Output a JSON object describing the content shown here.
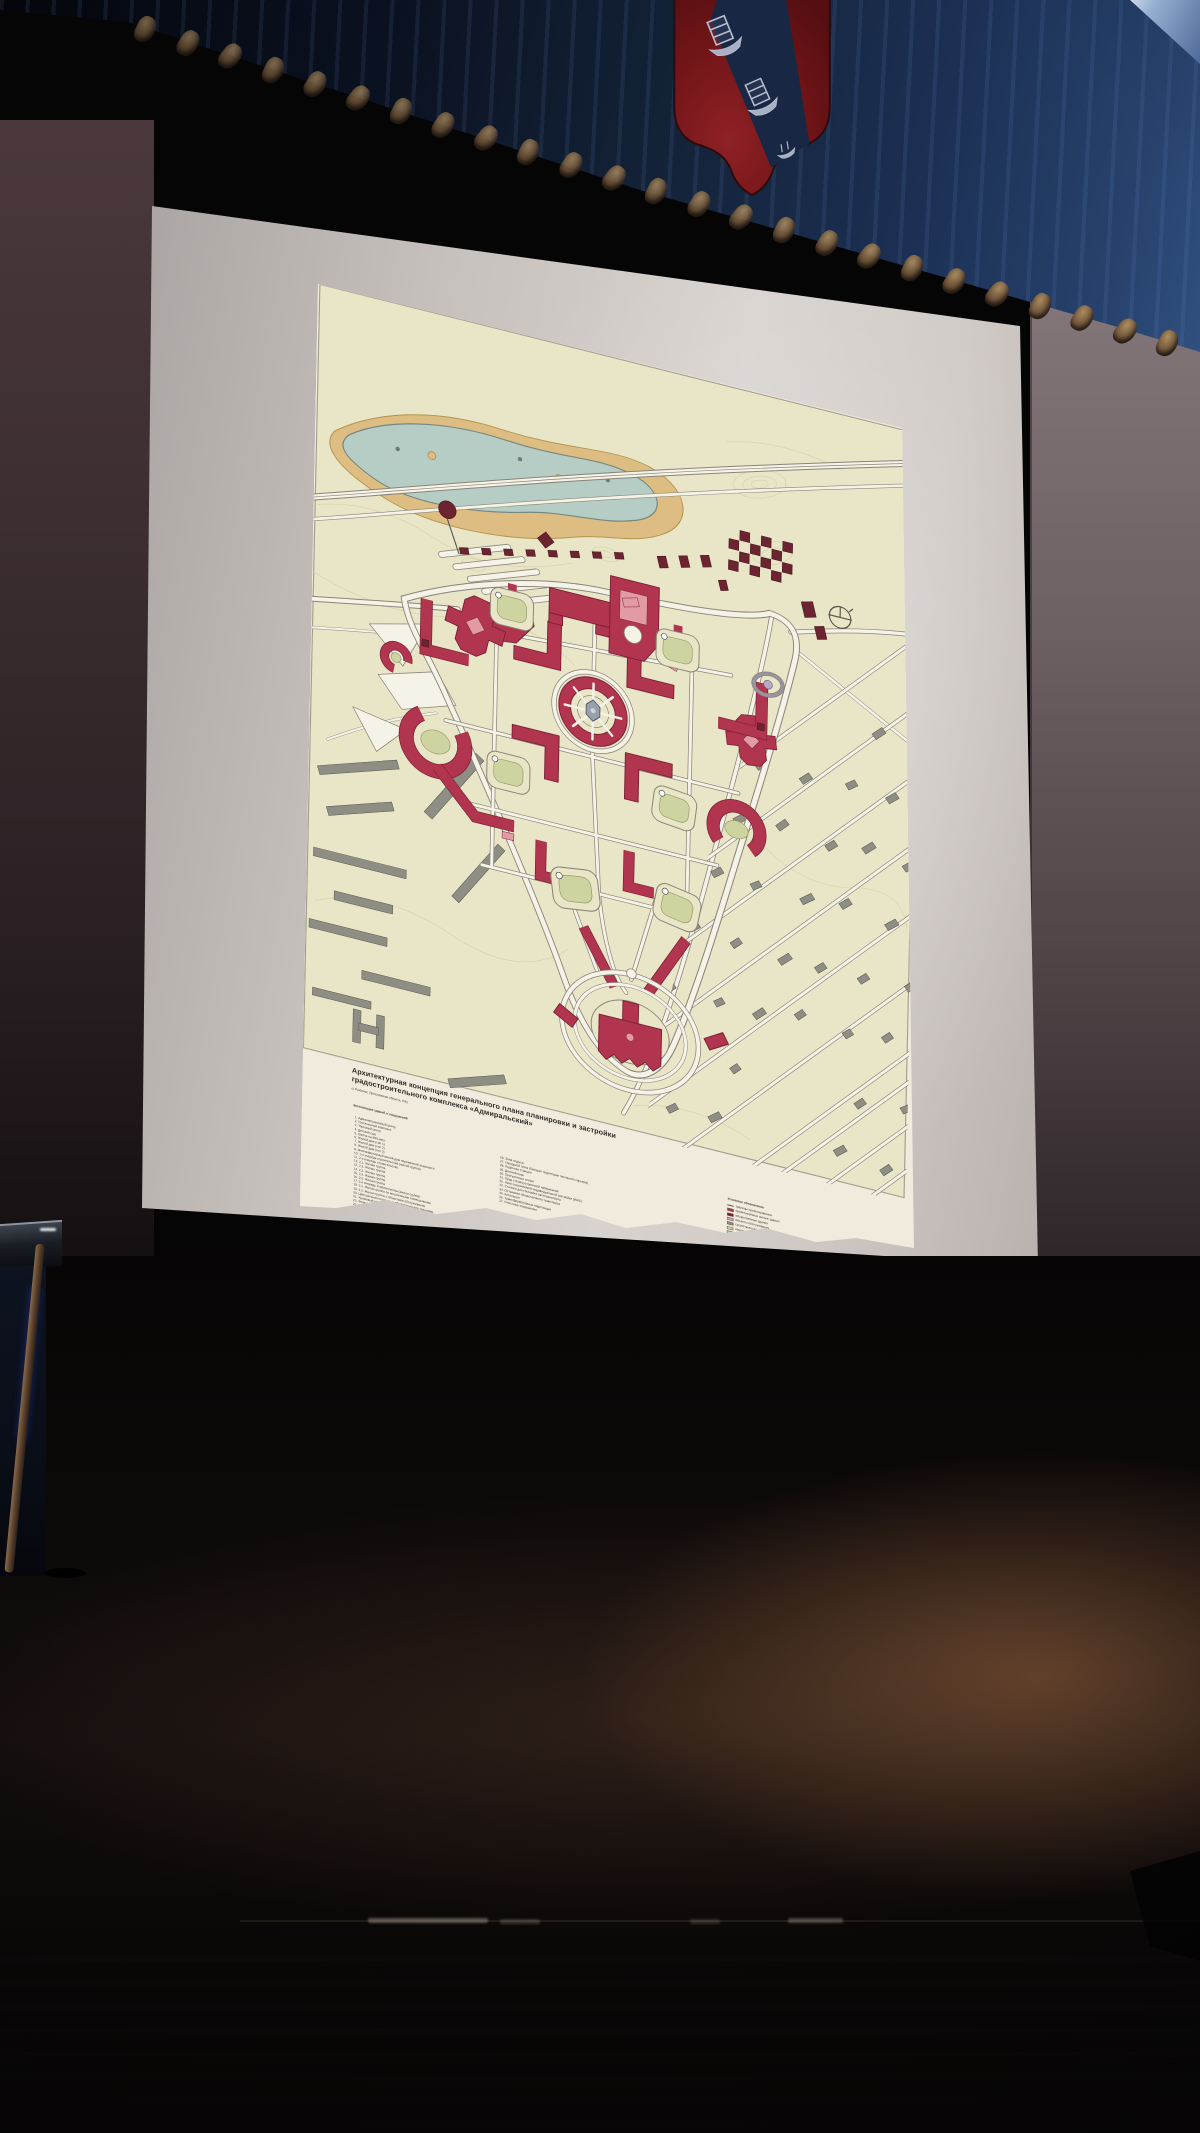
{
  "poster": {
    "title_line1": "Архитектурная концепция генерального плана планировки и застройки",
    "title_line2": "градостроительного комплекса «Адмиральский»",
    "subtitle": "(г. Рыбинск, Ярославская область, РФ)",
    "legend_title": "Экспликация зданий и сооружений",
    "legend_col1": [
      "1. Административный центр",
      "2. Гостиничный комплекс",
      "3. Торговый центр",
      "4. Детский сад",
      "5. Школа на 850 мест",
      "6. Жилой дом (тип 1)",
      "7. Жилой дом (тип 2)",
      "8. Жилой дом (тип 3)",
      "9. Многоквартирный жилой дом переменной этажности",
      "10. 1-я очередь строительства (жилая группа)",
      "11. 2-я очередь строительства",
      "12. 2.1. Жилая группа",
      "13. 2.2. Жилая группа",
      "14. 2.3. Жилая группа",
      "15. 2.4. Жилая группа",
      "16. 2.5. Жилая группа",
      "17. 3-я очередь строительства (жилая группа)",
      "18. 3.1. Жилая группа со встроенными помещениями",
      "19. 3.2. Жилая группа с объектами обслуживания",
      "20. Центральная площадь с общественными зданиями",
      "21. Храмовый комплекс",
      "22. Физкультурно-оздоровительный комплекс",
      "23. Бульвар с пешеходной аллеей",
      "24. Амфитеатр под открытым небом",
      "25. Гаражный комплекс на территории застройки (4 МЗ)"
    ],
    "legend_col2": [
      "26. Зона отдыха",
      "27. Городской пляж (бывшая территория песчаного карьера)",
      "28. Лодочная станция",
      "29. Детский парк",
      "30. Прогулочные аллеи",
      "31. Пруд с благоустроенной набережной",
      "32. Зона сохраняемой индивидуальной застройки (ИЖС)",
      "33. Стоянки для гостевого автотранспорта",
      "34. Остановки общественного транспорта",
      "35. Котельная",
      "36. Трансформаторные подстанции",
      "37. Очистные сооружения"
    ],
    "symbols_title": "Условные обозначения",
    "symbols": [
      {
        "label": "границы проектирования",
        "line": true,
        "color": "#55544c"
      },
      {
        "label": "проектируемые жилые здания",
        "color": "#b23550"
      },
      {
        "label": "общественные здания",
        "color": "#6d2431"
      },
      {
        "label": "объекты обслуживания",
        "color": "#e29aa4"
      },
      {
        "label": "существующая застройка",
        "color": "#8f8e85"
      },
      {
        "label": "озеленение",
        "color": "#ced49f"
      },
      {
        "label": "водоёмы",
        "color": "#b6cdc6"
      },
      {
        "label": "дороги и проезды",
        "color": "#f5f2e7"
      },
      {
        "label": "пешеходные зоны",
        "color": "#ddbd82"
      }
    ]
  },
  "map_colors": {
    "paper": "#f0ebdd",
    "field": "#e9e6c8",
    "water": "#b6cdc6",
    "sand": "#ddbd82",
    "red": "#b23550",
    "red_dark": "#7c2136",
    "maroon": "#6d2431",
    "pink": "#e29aa4",
    "gray_building": "#8f8e85",
    "road": "#f5f2e7",
    "road_edge": "#8a8478",
    "green": "#ced49f",
    "plaza_center": "#97a0ad",
    "contour": "#d8d1ab"
  },
  "scene_colors": {
    "curtain_blue": "#1c3054",
    "tassel_gold": "#8a7352",
    "shield_red": "#7c181b",
    "shield_blue": "#182743",
    "shield_silver": "#b9bfd0",
    "wall_left": "#3c2e31",
    "wall_right": "#6e6265",
    "screen_gray": "#c9c3c0",
    "floor_glow": "#9e6842",
    "led_blue": "#3550e0"
  }
}
